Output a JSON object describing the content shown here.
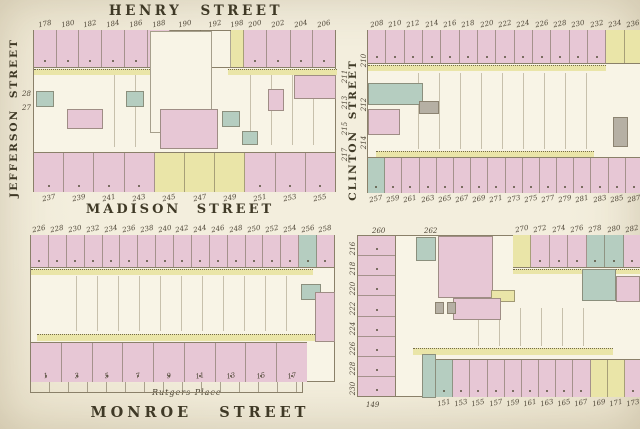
{
  "streets": {
    "henry": "HENRY STREET",
    "madison": "MADISON STREET",
    "monroe": "MONROE STREET",
    "jefferson": "JEFFERSON STREET",
    "clinton": "CLINTON STREET"
  },
  "landmarks": {
    "coopers_yard": "Cooper's Yard",
    "institute_line1": "Rutgers",
    "institute_line2": "Female",
    "institute_line3": "Institute",
    "rutgers_place": "Rutgers Place"
  },
  "colors": {
    "paper": "#f1ecdc",
    "lotfill": "#f8f4e6",
    "pink": "#e7c7d5",
    "yellow": "#eae5a8",
    "green": "#b5cdc0",
    "gray": "#b6b0a4",
    "line": "#8a8069",
    "ink": "#3f3926",
    "num": "#4f4738"
  },
  "blocks": {
    "henry_madison_west": {
      "top": {
        "numbers": [
          "178",
          "180",
          "182",
          "184",
          "186",
          "188",
          "190",
          "192",
          "198",
          "200",
          "202",
          "204",
          "206"
        ],
        "colors": [
          "pink",
          "pink",
          "pink",
          "pink",
          "pink",
          "pink",
          "open",
          "open",
          "yellow",
          "pink",
          "pink",
          "pink",
          "pink"
        ],
        "flex": [
          1,
          1,
          1,
          1,
          1,
          1,
          1.35,
          1.35,
          0.55,
          1,
          1.05,
          1,
          1
        ]
      },
      "bottom": {
        "numbers": [
          "237",
          "239",
          "241",
          "243",
          "245",
          "247",
          "249",
          "251",
          "253",
          "255"
        ],
        "colors": [
          "pink",
          "pink",
          "pink",
          "pink",
          "yellow",
          "yellow",
          "yellow",
          "pink",
          "pink",
          "pink"
        ]
      },
      "left_numbers": [
        "28",
        "27"
      ],
      "right_numbers": [
        "211",
        "213",
        "215",
        "217"
      ]
    },
    "henry_madison_east": {
      "top": {
        "numbers": [
          "208",
          "210",
          "212",
          "214",
          "216",
          "218",
          "220",
          "222",
          "224",
          "226",
          "228",
          "230",
          "232",
          "234",
          "236"
        ],
        "colors": [
          "pink",
          "pink",
          "pink",
          "pink",
          "pink",
          "pink",
          "pink",
          "pink",
          "pink",
          "pink",
          "pink",
          "pink",
          "pink",
          "yellow",
          "yellow"
        ]
      },
      "bottom": {
        "numbers": [
          "257",
          "259",
          "261",
          "263",
          "265",
          "267",
          "269",
          "271",
          "273",
          "275",
          "277",
          "279",
          "281",
          "283",
          "285",
          "287"
        ],
        "colors": [
          "green",
          "pink",
          "pink",
          "pink",
          "pink",
          "pink",
          "pink",
          "pink",
          "pink",
          "pink",
          "pink",
          "pink",
          "pink",
          "pink",
          "pink",
          "pink"
        ]
      },
      "left_numbers": [
        "210",
        "212",
        "214"
      ]
    },
    "madison_monroe_west": {
      "top": {
        "numbers": [
          "226",
          "228",
          "230",
          "232",
          "234",
          "236",
          "238",
          "240",
          "242",
          "244",
          "246",
          "248",
          "250",
          "252",
          "254",
          "256",
          "258"
        ],
        "colors": [
          "pink",
          "pink",
          "pink",
          "pink",
          "pink",
          "pink",
          "pink",
          "pink",
          "pink",
          "pink",
          "pink",
          "pink",
          "pink",
          "pink",
          "pink",
          "green",
          "pink"
        ]
      },
      "bottom": {
        "numbers": [
          "1",
          "3",
          "5",
          "7",
          "9",
          "11",
          "13",
          "15",
          "17"
        ],
        "colors": [
          "pink",
          "pink",
          "pink",
          "pink",
          "pink",
          "pink",
          "pink",
          "pink",
          "pink"
        ]
      }
    },
    "madison_monroe_east": {
      "left": {
        "numbers": [
          "216",
          "218",
          "220",
          "222",
          "224",
          "226",
          "228",
          "230"
        ],
        "colors": [
          "pink",
          "pink",
          "pink",
          "pink",
          "pink",
          "pink",
          "pink",
          "pink"
        ]
      },
      "topright": {
        "numbers": [
          "270",
          "272",
          "274",
          "276",
          "278",
          "280",
          "282"
        ],
        "colors": [
          "yellow",
          "pink",
          "pink",
          "pink",
          "green",
          "green",
          "pink"
        ]
      },
      "bottom": {
        "numbers": [
          "151",
          "153",
          "155",
          "157",
          "159",
          "161",
          "163",
          "165",
          "167",
          "169",
          "171",
          "173"
        ],
        "colors": [
          "green",
          "pink",
          "pink",
          "pink",
          "pink",
          "pink",
          "pink",
          "pink",
          "pink",
          "yellow",
          "yellow",
          "pink"
        ]
      },
      "top_scatter": [
        "260",
        "262"
      ],
      "corner_number": "149"
    }
  }
}
